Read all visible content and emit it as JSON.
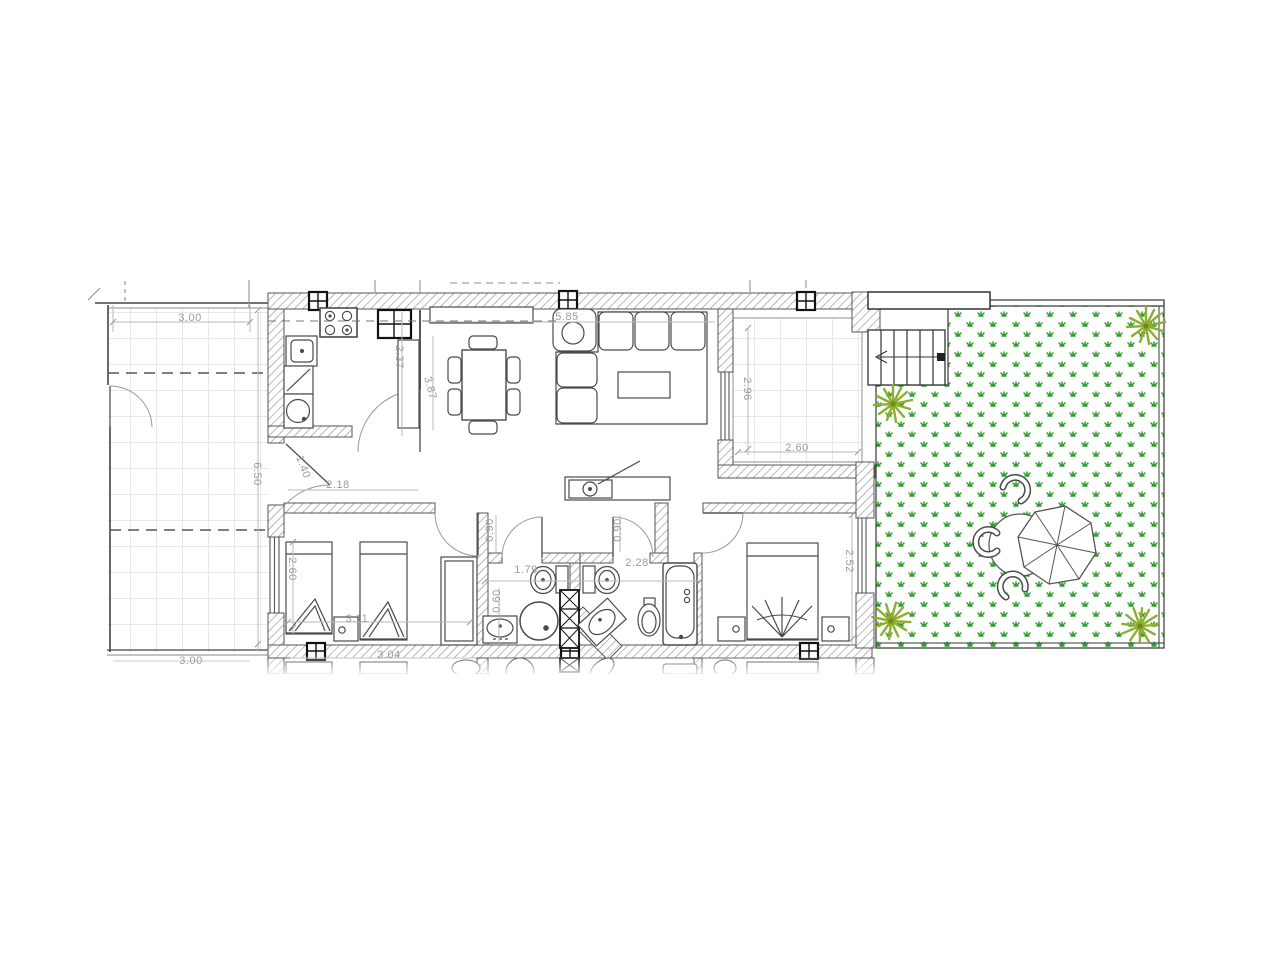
{
  "drawing": {
    "type": "architectural-floor-plan",
    "colors": {
      "wall_line": "#4a4a4a",
      "hatch": "#9a9a9a",
      "tile_grid": "#cfcfcf",
      "dim_text": "#9c9c9c",
      "dim_line": "#b5b5b5",
      "grass_green": "#2e9e2e",
      "palm_green": "#8fae2f",
      "stairs_line": "#333333"
    },
    "symbols": [
      "palm-tree",
      "grass-hatch",
      "umbrella-table",
      "garden-chair",
      "stairs",
      "stove",
      "fridge",
      "kitchen-sink",
      "washing-machine",
      "dining-table",
      "sofa",
      "armchair",
      "coffee-table",
      "desk",
      "single-bed",
      "double-bed",
      "nightstand",
      "wardrobe",
      "toilet",
      "shower",
      "bathroom-sink",
      "bidet",
      "bathtub",
      "window",
      "door-swing"
    ]
  },
  "dims": [
    {
      "id": "terrace-left-width",
      "text": "3.00"
    },
    {
      "id": "terrace-left-depth",
      "text": "6.50"
    },
    {
      "id": "kitchen-depth",
      "text": "2.37"
    },
    {
      "id": "living-depth",
      "text": "3.87"
    },
    {
      "id": "living-width",
      "text": "5.85"
    },
    {
      "id": "terrace-right-depth",
      "text": "2.96"
    },
    {
      "id": "terrace-right-width",
      "text": "2.60"
    },
    {
      "id": "entrance-door-width",
      "text": "1.40"
    },
    {
      "id": "hall-width",
      "text": "2.18"
    },
    {
      "id": "bath1-door-width",
      "text": "0.90"
    },
    {
      "id": "bath2-door-width",
      "text": "0.90"
    },
    {
      "id": "bath1-width",
      "text": "1.79"
    },
    {
      "id": "bath2-width",
      "text": "2.28"
    },
    {
      "id": "bath1-sink-width",
      "text": "0.60"
    },
    {
      "id": "bedroom1-depth",
      "text": "2.60"
    },
    {
      "id": "bedroom1-width",
      "text": "3.11"
    },
    {
      "id": "bedroom2-depth",
      "text": "2.52"
    },
    {
      "id": "bedroom1-total-width",
      "text": "3.04"
    },
    {
      "id": "terrace-left-bottom",
      "text": "3.00"
    }
  ]
}
